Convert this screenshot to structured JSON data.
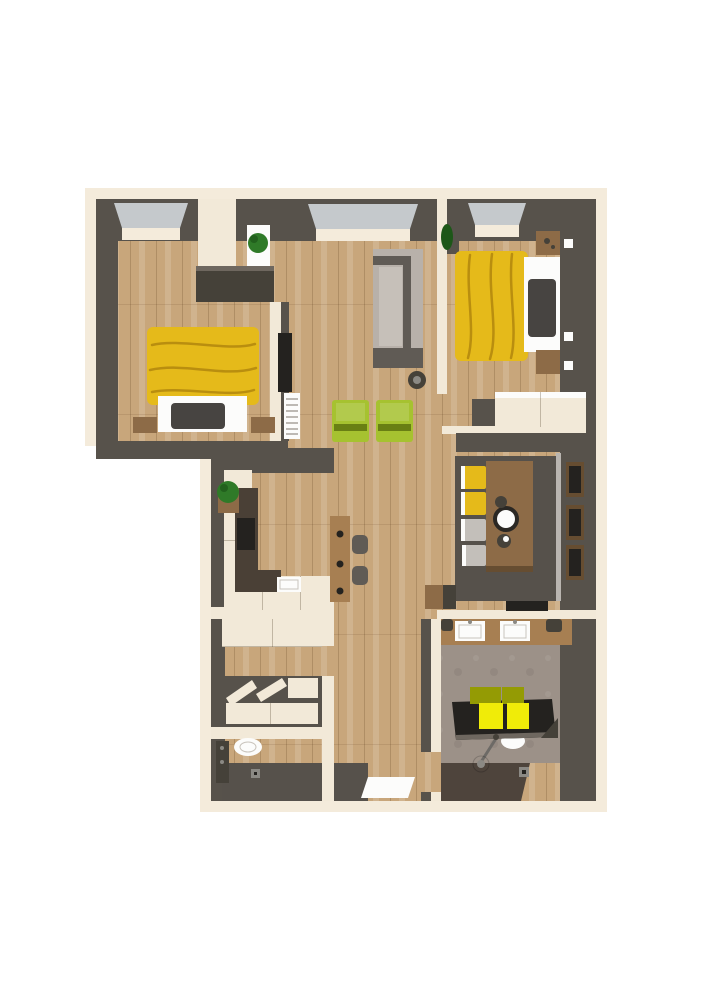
{
  "meta": {
    "description": "3D top-down rendered floor plan of an apartment, no visible text labels",
    "view": "bird's-eye 3D render",
    "visible_text": ""
  },
  "palette": {
    "bg": "#ffffff",
    "trim": "#f4ebdb",
    "wall": "#57524b",
    "wall_deep": "#454139",
    "wall_light": "#6e675f",
    "floor_wood": "#c8a67b",
    "floor_dark": "#56514b",
    "concrete": "#9c9188",
    "shower_floor": "#4e443c",
    "cream": "#f2e9d8",
    "white": "#fcfcfb",
    "glass": "#c5c9cc",
    "yellow": "#e5ba1a",
    "towel_bright": "#f0ec08",
    "towel_olive": "#949b04",
    "green_chair": "#a6c230",
    "green_dark": "#697f14",
    "plant": "#2f7a28",
    "plant_dark": "#1d5718",
    "sofa_light": "#b8b1aa",
    "sofa_seat": "#c6c0b9",
    "sofa_dark": "#605b55",
    "wood_mid": "#8d6b47",
    "wood_warm": "#a77f52",
    "wood_dark": "#664d31",
    "counter": "#4a4036",
    "pillow": "#474441",
    "black": "#24221f",
    "gray_chair": "#c3bfba",
    "metal": "#8b8984",
    "light_edge": "#b9b5b0"
  },
  "scene": {
    "rooms": [
      {
        "name": "bedroom-left",
        "furniture": [
          "double-bed-yellow-blanket",
          "pillow",
          "nightstand x2",
          "built-in-closet",
          "radiator",
          "window"
        ]
      },
      {
        "name": "living-room",
        "furniture": [
          "gray-sofa",
          "green-armchair x2",
          "plant-on-pedestal",
          "decor-basket",
          "wall-tv",
          "window"
        ]
      },
      {
        "name": "bedroom-right",
        "furniture": [
          "double-bed-yellow-blanket",
          "pillow",
          "nightstand x2",
          "wardrobe",
          "plant",
          "window",
          "wall-socket x3"
        ]
      },
      {
        "name": "kitchen",
        "furniture": [
          "cream-cabinets",
          "dark-countertop",
          "cooktop",
          "sink",
          "plant",
          "bar-island",
          "bar-stool x2"
        ]
      },
      {
        "name": "dining-area",
        "furniture": [
          "wood-table",
          "plates",
          "yellow-chair x2",
          "gray-chair x2",
          "wall-shelf-unit",
          "sideboard"
        ]
      },
      {
        "name": "storage-room",
        "furniture": [
          "top-cabinet",
          "open-shelf-unit"
        ]
      },
      {
        "name": "wc",
        "furniture": [
          "toilet",
          "radiator",
          "floor-drain"
        ]
      },
      {
        "name": "hallway",
        "furniture": [
          "entrance-mat"
        ]
      },
      {
        "name": "bathroom",
        "furniture": [
          "wood-vanity",
          "sink x2",
          "towel x2",
          "bench-with-yellow-towels",
          "shower-head",
          "shower-tray",
          "floor-drain"
        ]
      }
    ]
  }
}
